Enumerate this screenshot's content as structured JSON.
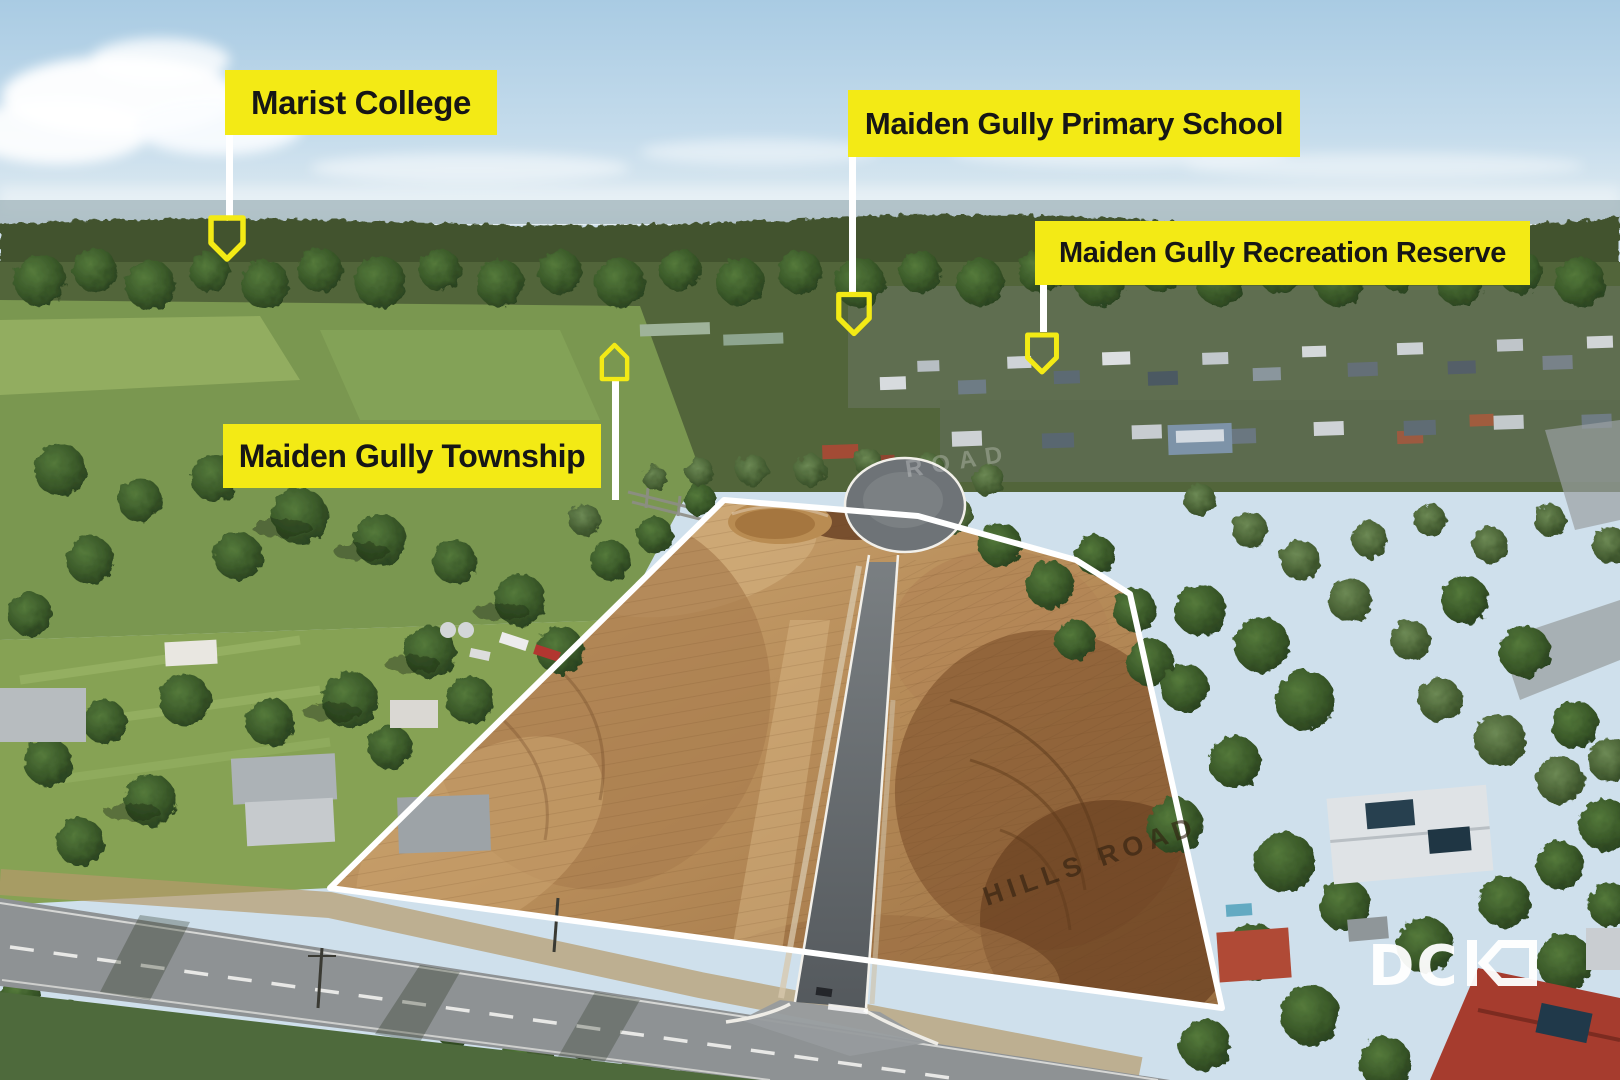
{
  "callouts": [
    {
      "label": "Marist College",
      "marker_icon": "map-pin-icon"
    },
    {
      "label": "Maiden Gully Primary School",
      "marker_icon": "map-pin-icon"
    },
    {
      "label": "Maiden Gully Recreation Reserve",
      "marker_icon": "map-pin-icon"
    },
    {
      "label": "Maiden Gully Township",
      "marker_icon": "house-icon"
    }
  ],
  "road_labels": {
    "hills_road": "HILLS ROAD",
    "faint_cross_road": "ROAD"
  },
  "logo": {
    "text": "DCK",
    "letters_shown": "DC"
  },
  "colors": {
    "callout_background": "#F3EA15",
    "callout_text": "#161616",
    "connector": "#FFFFFF",
    "boundary_outline": "#FFFFFF",
    "logo_color": "#FFFFFF"
  }
}
